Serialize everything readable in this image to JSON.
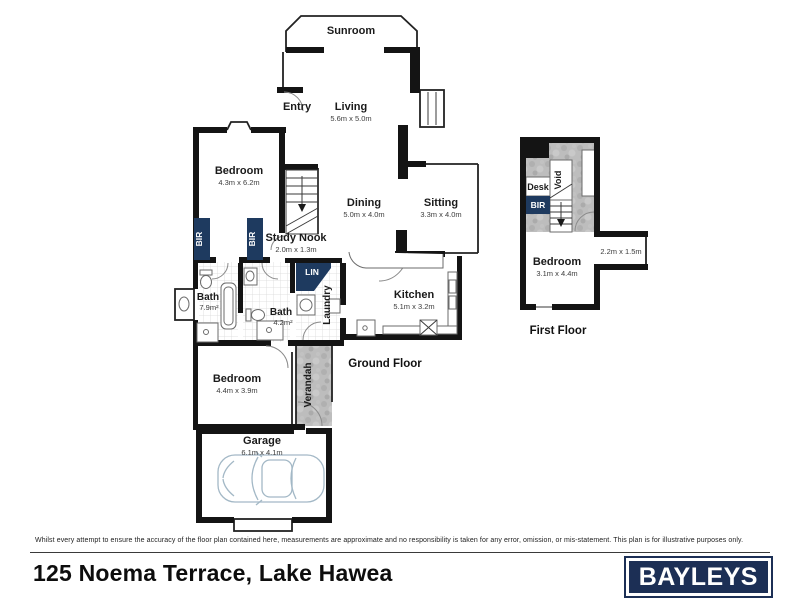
{
  "plan": {
    "ground": {
      "title": "Ground Floor",
      "rooms": {
        "sunroom": {
          "name": "Sunroom"
        },
        "living": {
          "name": "Living",
          "dims": "5.6m x 5.0m"
        },
        "entry": {
          "name": "Entry"
        },
        "bedroom1": {
          "name": "Bedroom",
          "dims": "4.3m x 6.2m"
        },
        "bir": {
          "name": "BIR"
        },
        "study_nook": {
          "name": "Study Nook",
          "dims": "2.0m x 1.3m"
        },
        "dining": {
          "name": "Dining",
          "dims": "5.0m x 4.0m"
        },
        "sitting": {
          "name": "Sitting",
          "dims": "3.3m x 4.0m"
        },
        "bath_main": {
          "name": "Bath",
          "area": "7.9m²"
        },
        "bath_second": {
          "name": "Bath",
          "area": "4.2m²"
        },
        "linen": {
          "name": "LIN"
        },
        "laundry": {
          "name": "Laundry"
        },
        "kitchen": {
          "name": "Kitchen",
          "dims": "5.1m x 3.2m"
        },
        "bedroom2": {
          "name": "Bedroom",
          "dims": "4.4m x 3.9m"
        },
        "verandah": {
          "name": "Verandah"
        },
        "garage": {
          "name": "Garage",
          "dims": "6.1m x 4.1m"
        }
      }
    },
    "first": {
      "title": "First Floor",
      "rooms": {
        "desk": {
          "name": "Desk"
        },
        "bir": {
          "name": "BIR"
        },
        "void": {
          "name": "Void"
        },
        "bedroom": {
          "name": "Bedroom",
          "dims": "3.1m x 4.4m"
        },
        "nook_dims": "2.2m x 1.5m"
      }
    }
  },
  "footer": {
    "disclaimer": "Whilst every attempt to ensure the accuracy of the floor plan contained here, measurements are approximate and no responsibility is taken for any error, omission, or mis-statement. This plan is for illustrative purposes only.",
    "address": "125 Noema Terrace, Lake Hawea",
    "logo_text": "BAYLEYS"
  },
  "colors": {
    "wall": "#141414",
    "robe_navy": "#1e3a5f",
    "logo_navy": "#1c2f55",
    "deck_gray": "#bdbdbd",
    "tile_line": "#d9d9d9",
    "car_outline": "#a3b8c6"
  }
}
